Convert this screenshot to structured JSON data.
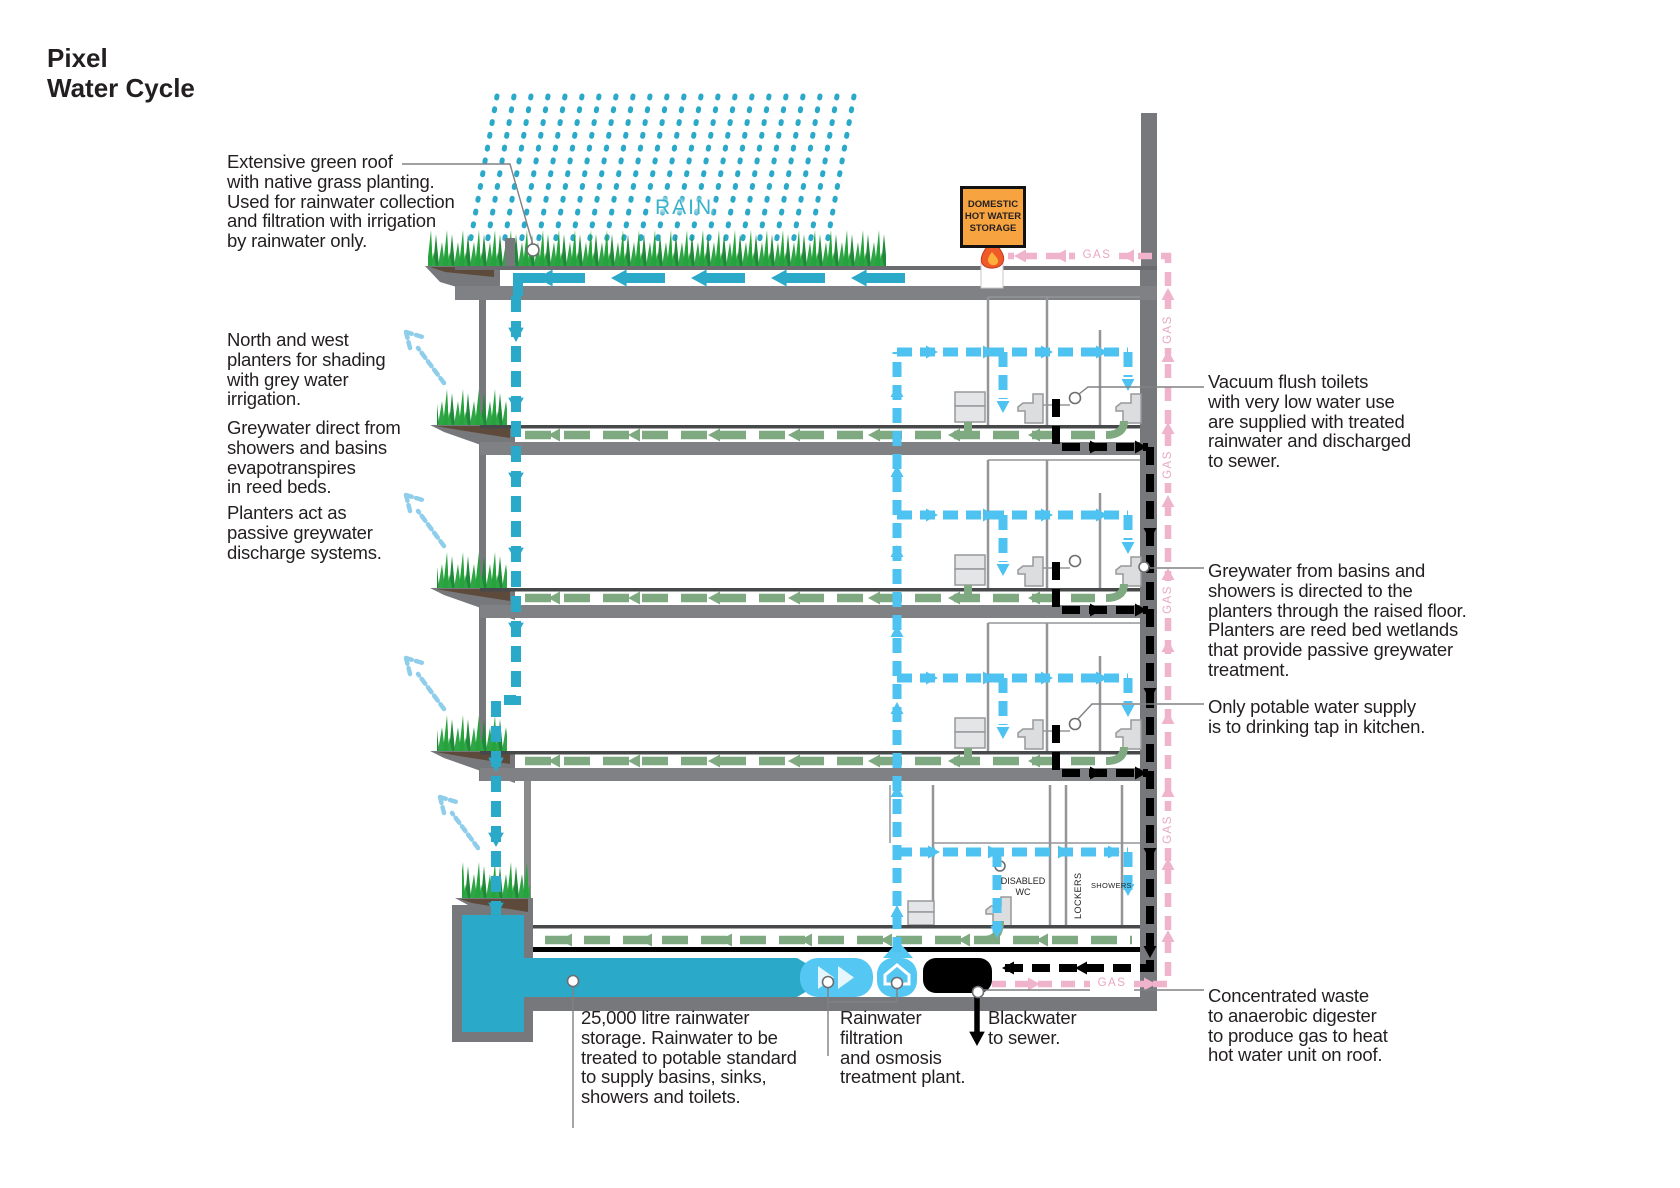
{
  "title": "Pixel\nWater Cycle",
  "annotations": {
    "green_roof": "Extensive green roof\nwith native grass planting.\nUsed for rainwater collection\nand filtration with irrigation\nby rainwater only.",
    "planters_shading": "North and west\nplanters for shading\nwith grey water\nirrigation.",
    "greywater_direct": "Greywater direct from\nshowers and basins\nevapotranspires\nin reed beds.",
    "planters_passive": "Planters act as\npassive greywater\ndischarge systems.",
    "vacuum_toilets": "Vacuum flush toilets\nwith very low water use\nare supplied with treated\nrainwater and discharged\nto sewer.",
    "greywater_basins": "Greywater from basins and\nshowers is directed to the\nplanters through the raised floor.\nPlanters are reed bed wetlands\nthat provide passive greywater\ntreatment.",
    "potable_supply": "Only potable water supply\nis to drinking tap in kitchen.",
    "concentrated_waste": "Concentrated waste\nto anaerobic digester\nto produce gas to heat\nhot water unit on roof.",
    "rainwater_storage": "25,000 litre rainwater\nstorage. Rainwater to be\ntreated to potable standard\nto supply basins, sinks,\nshowers and toilets.",
    "rainwater_filtration": "Rainwater\nfiltration\nand osmosis\ntreatment plant.",
    "blackwater_sewer": "Blackwater\nto sewer."
  },
  "labels": {
    "rain": "RAIN",
    "gas": "GAS",
    "dhw_storage": "DOMESTIC HOT WATER STORAGE",
    "disabled_wc": "DISABLED\nWC",
    "lockers": "LOCKERS",
    "showers": "SHOWERS"
  },
  "colors": {
    "rainwater_teal": "#2AA9C9",
    "treated_water_blue": "#4EC3F1",
    "greywater_green": "#7FA980",
    "blackwater_black": "#000000",
    "gas_pink": "#F0B3CC",
    "structure_grey": "#77787B",
    "dhw_orange": "#F7A440",
    "grass_green": "#2FA646",
    "soil_brown": "#5D4A3B"
  }
}
